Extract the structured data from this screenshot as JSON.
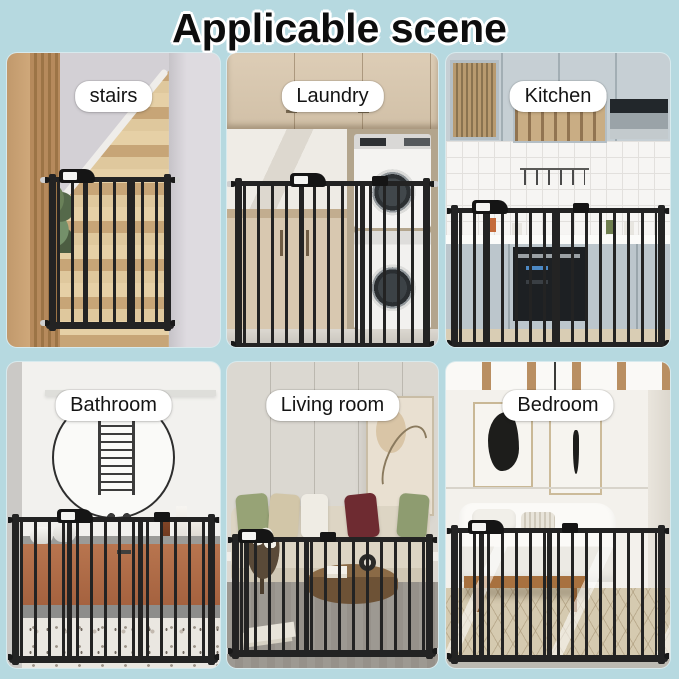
{
  "title": "Applicable scene",
  "palette": {
    "background": "#b6d9e0",
    "gate_black": "#232323",
    "label_bg": "#ffffff",
    "label_text": "#141414",
    "title_text": "#0d0d0d",
    "title_outline": "#ffffff"
  },
  "scenes": [
    {
      "id": "stairs",
      "label": "stairs"
    },
    {
      "id": "laundry",
      "label": "Laundry"
    },
    {
      "id": "kitchen",
      "label": "Kitchen"
    },
    {
      "id": "bathroom",
      "label": "Bathroom"
    },
    {
      "id": "living-room",
      "label": "Living room"
    },
    {
      "id": "bedroom",
      "label": "Bedroom"
    }
  ]
}
